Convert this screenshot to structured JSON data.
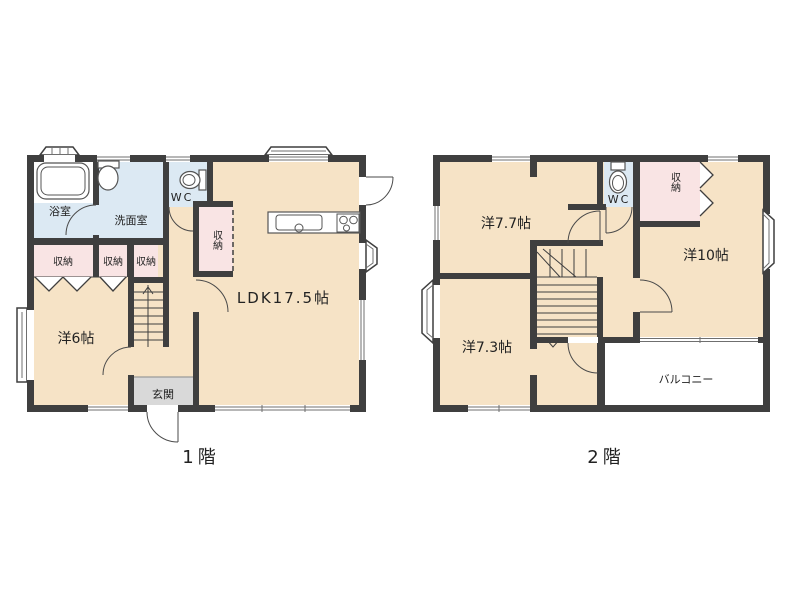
{
  "palette": {
    "wall": "#3f3f3f",
    "room": "#f6e3c6",
    "wet": "#dce9f3",
    "closet": "#f9e4e4",
    "entrance": "#d9d9d9",
    "paper": "#ffffff",
    "text": "#222222"
  },
  "floor1": {
    "caption": "1階",
    "rooms": {
      "bath": "浴室",
      "washroom": "洗面室",
      "toilet": "WC",
      "closet_a": "収納",
      "closet_b": "収納",
      "closet_c": "収納",
      "closet_hall": "収納",
      "bedroom6": "洋6帖",
      "ldk": "LDK17.5帖",
      "entrance": "玄関"
    }
  },
  "floor2": {
    "caption": "2階",
    "rooms": {
      "bedroom77": "洋7.7帖",
      "toilet": "WC",
      "closet": "収納",
      "bedroom10": "洋10帖",
      "bedroom73": "洋7.3帖",
      "balcony": "バルコニー"
    }
  }
}
